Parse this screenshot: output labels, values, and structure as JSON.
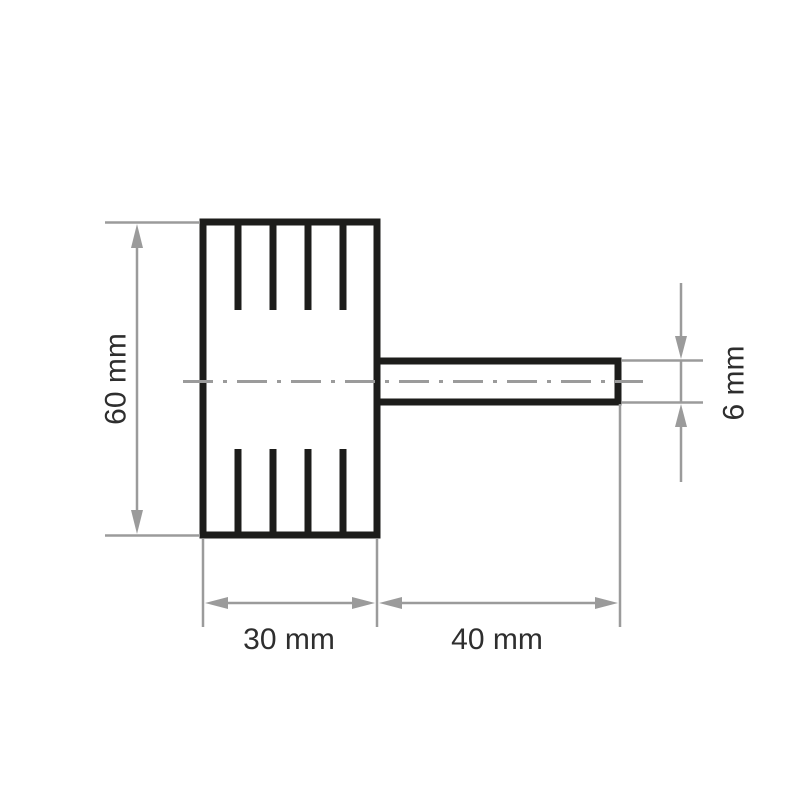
{
  "figure": {
    "kind": "technical-drawing",
    "subject": "flap-wheel-with-shaft",
    "labels": {
      "wheel_diameter": "60 mm",
      "wheel_width": "30 mm",
      "shaft_length": "40 mm",
      "shaft_diameter": "6 mm"
    },
    "dimensions_mm": {
      "wheel_diameter": 60,
      "wheel_width": 30,
      "shaft_length": 40,
      "shaft_diameter": 6
    },
    "colors": {
      "outline": "#1d1d1b",
      "dimension": "#9b9b9b",
      "text": "#2e2e2e",
      "background": "#ffffff"
    }
  }
}
